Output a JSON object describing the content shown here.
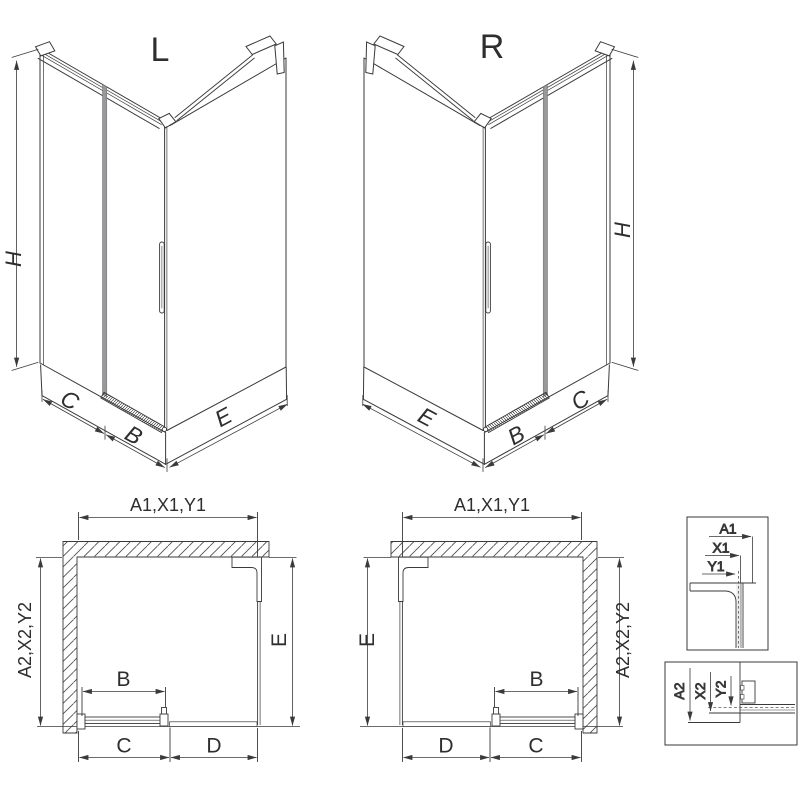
{
  "title_left": "L",
  "title_right": "R",
  "iso_left": {
    "dim_h": "H",
    "dim_c": "C",
    "dim_b": "B",
    "dim_e": "E"
  },
  "iso_right": {
    "dim_h": "H",
    "dim_e": "E",
    "dim_b": "B",
    "dim_c": "C"
  },
  "plan_left": {
    "dim_top": "A1,X1,Y1",
    "dim_left": "A2,X2,Y2",
    "dim_right": "E",
    "dim_b": "B",
    "dim_c": "C",
    "dim_d": "D"
  },
  "plan_right": {
    "dim_top": "A1,X1,Y1",
    "dim_left": "E",
    "dim_right": "A2,X2,Y2",
    "dim_b": "B",
    "dim_d": "D",
    "dim_c": "C"
  },
  "detail_top": {
    "dim_a1": "A1",
    "dim_x1": "X1",
    "dim_y1": "Y1"
  },
  "detail_bottom": {
    "dim_a2": "A2",
    "dim_x2": "X2",
    "dim_y2": "Y2"
  },
  "colors": {
    "line": "#3a3a3a",
    "gray": "#98999b",
    "background": "#ffffff"
  }
}
